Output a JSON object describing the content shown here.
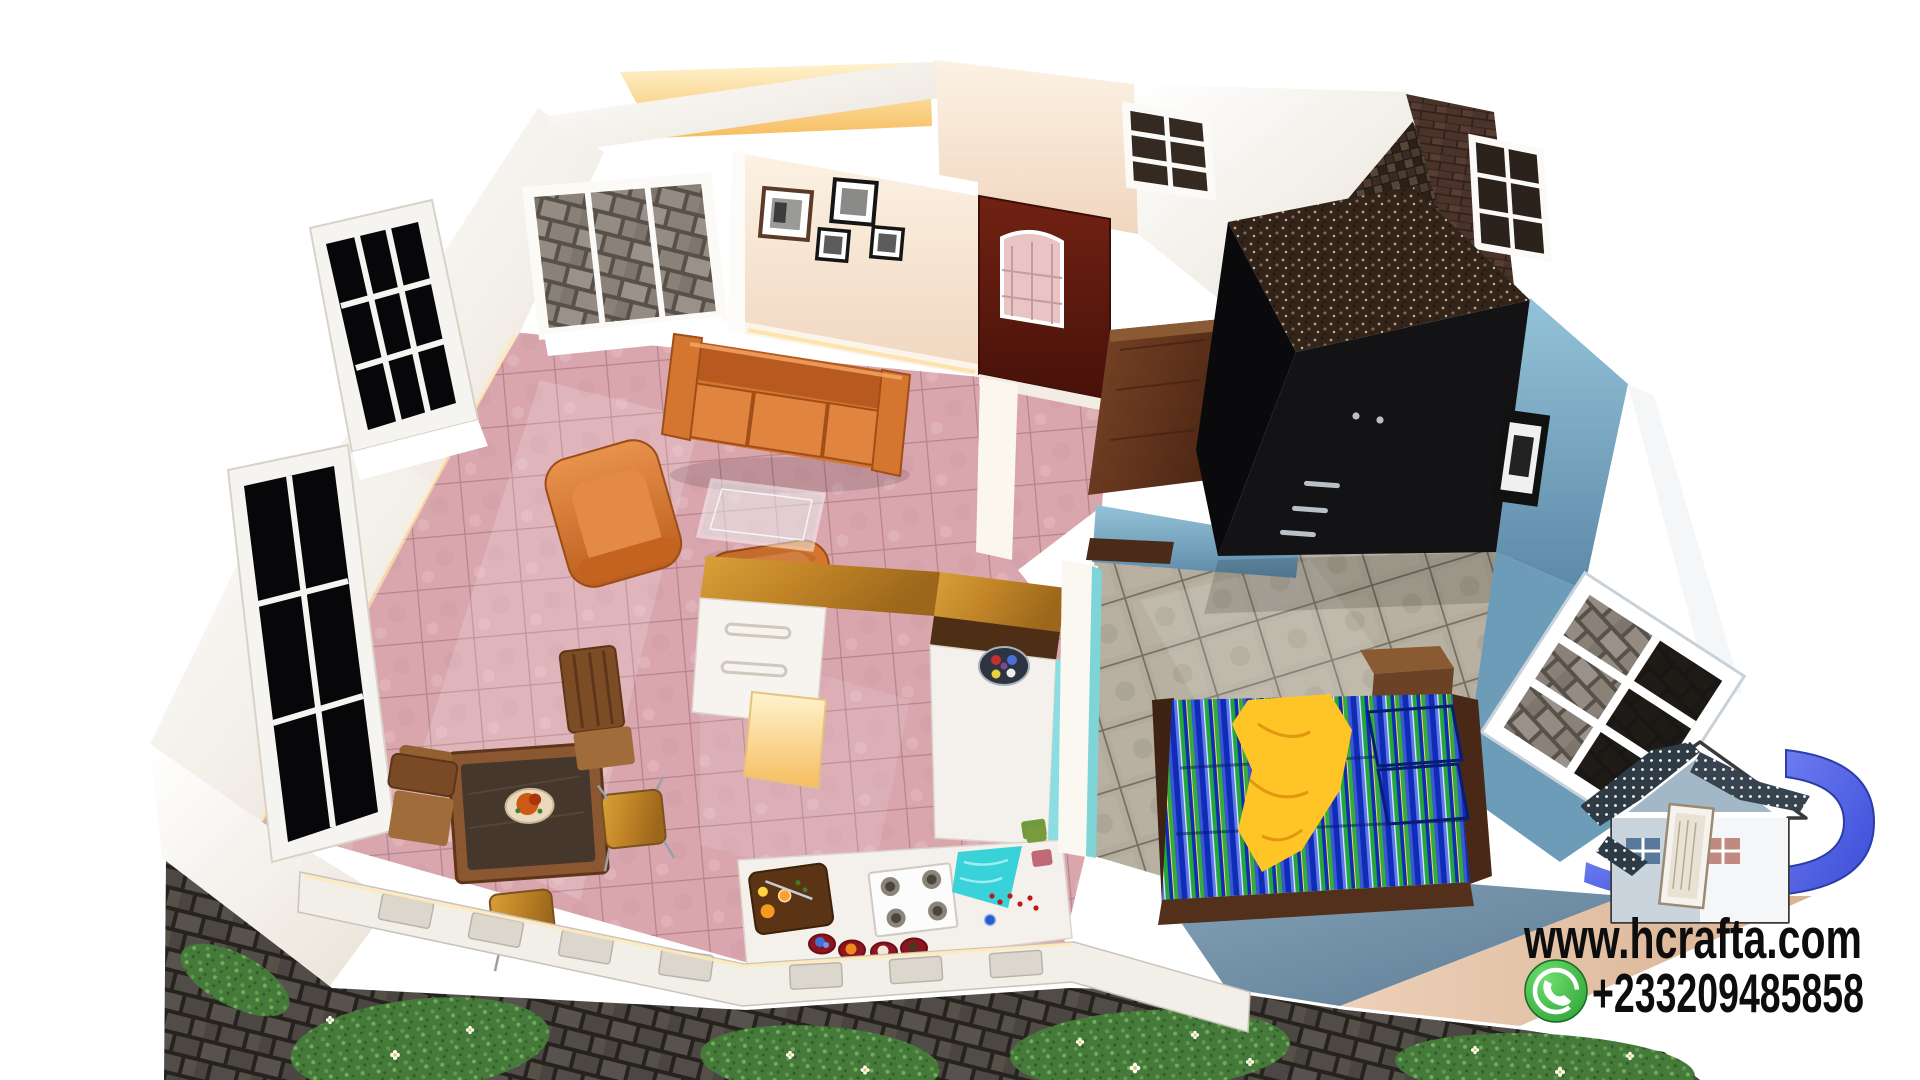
{
  "meta": {
    "title": "Aerial 3D cutaway rendering of a small house interior",
    "background_color": "#ffffff"
  },
  "watermark": {
    "website": "www.hcrafta.com",
    "phone": "+233209485858",
    "whatsapp_icon": "whatsapp-phone-icon",
    "text_color": "#0d0d0d",
    "whatsapp_green": "#3fae44"
  },
  "logo": {
    "name": "hcrafta-house-logo",
    "house_color": "#ffffff",
    "gable_color": "#a2b8c6",
    "swoosh_color": "#5a6ae6",
    "ribbon_color": "#2e3a44"
  },
  "palette": {
    "living_floor_tile": "#dcaab2",
    "bedroom_floor_tile": "#b5ae9f",
    "bathroom_mosaic": "#3f342b",
    "wall_cream": "#f7ead9",
    "wall_blue": "#6d9cb8",
    "sofa_orange": "#d4762f",
    "wood_counter": "#c8902f",
    "entry_door_maroon": "#5e1a0e",
    "wardrobe_black": "#131316",
    "bed_stripe_blue": "#0e2cb6",
    "bed_stripe_green": "#2fae3f",
    "blanket_yellow": "#ffc425",
    "kitchen_cloth_cyan": "#39d2d8",
    "grass_green": "#467a3a",
    "paver_gray": "#55504e"
  }
}
